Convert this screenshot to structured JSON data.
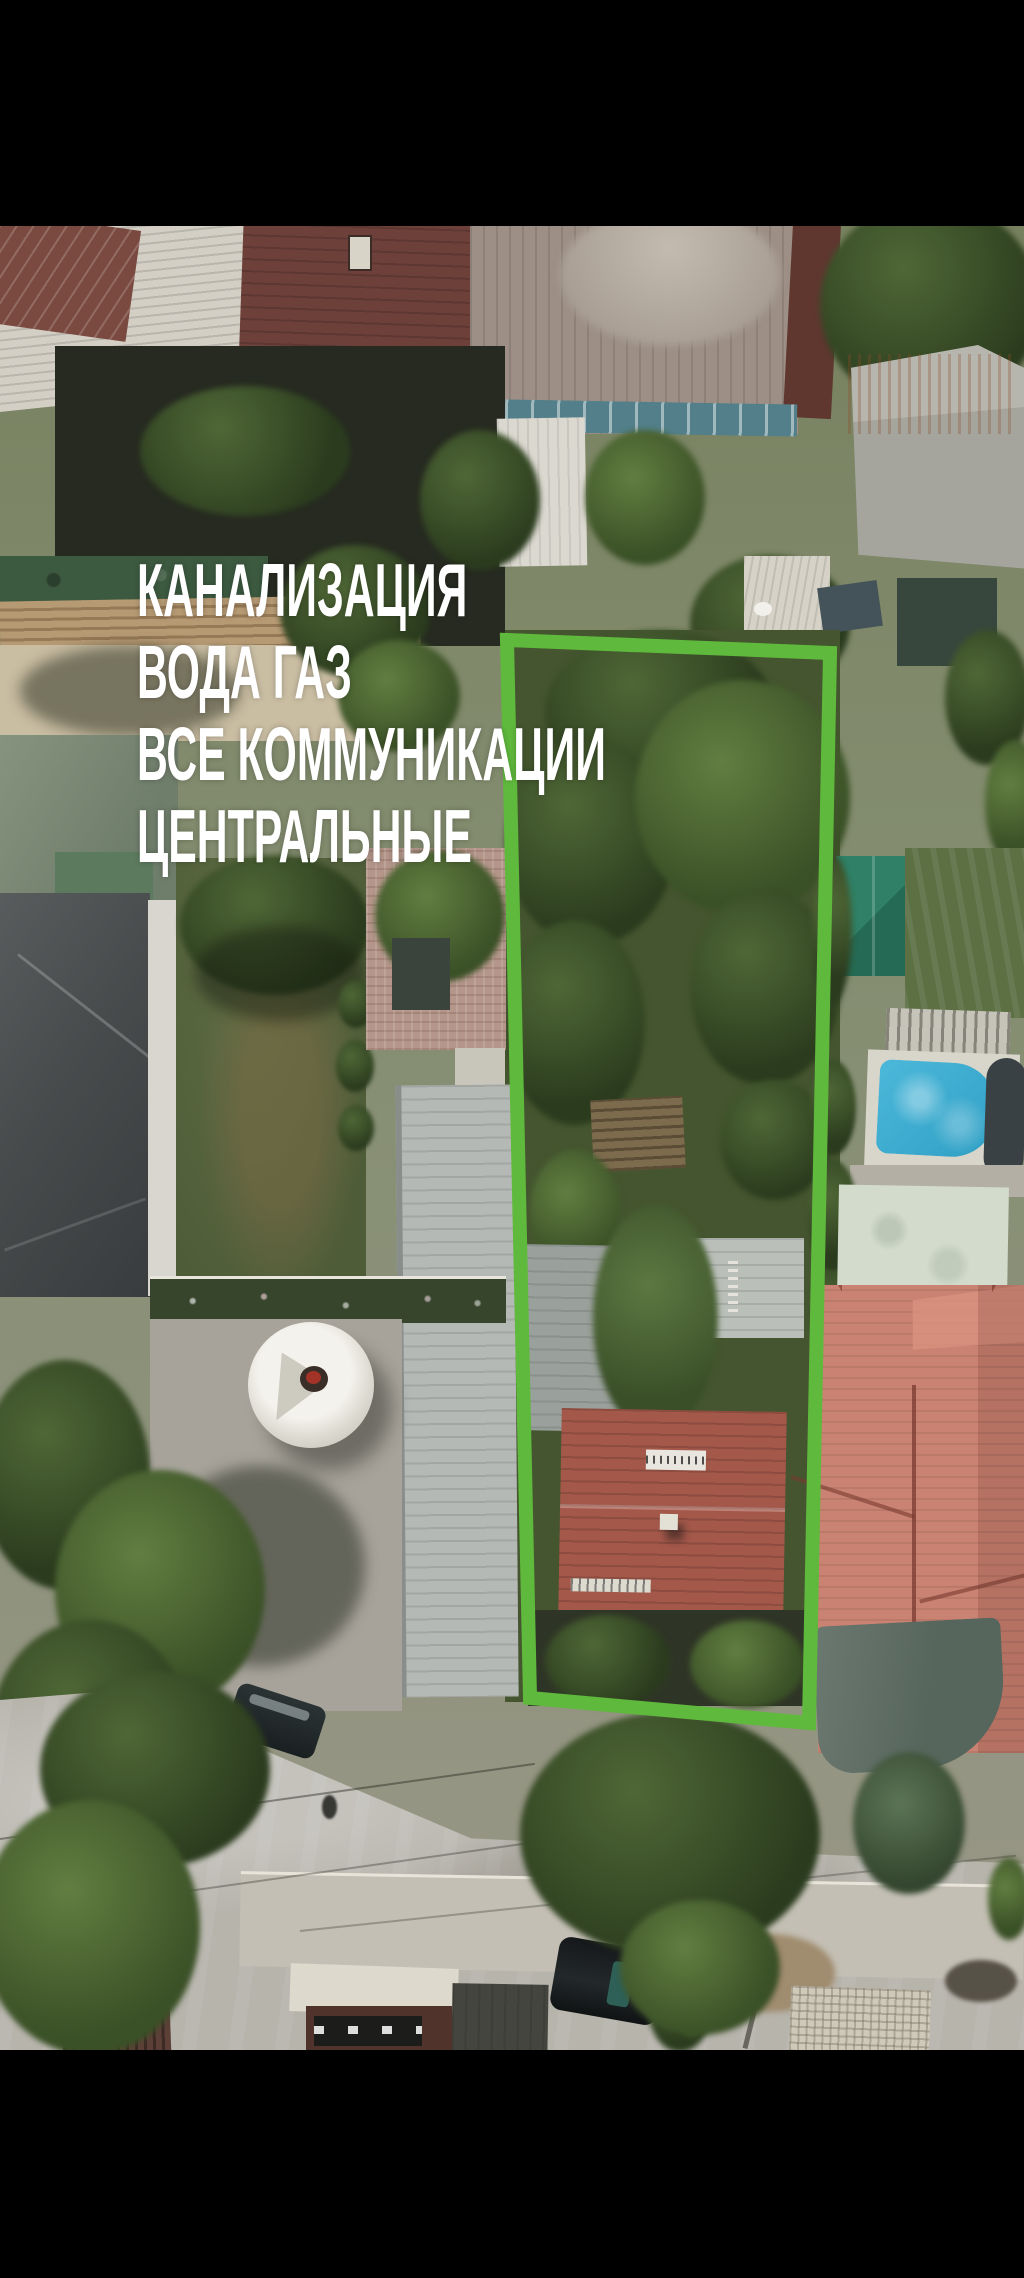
{
  "video_frame": {
    "letterbox_color": "#000000"
  },
  "overlay": {
    "lines": [
      "КАНАЛИЗАЦИЯ",
      "ВОДА ГАЗ",
      "ВСЕ КОММУНИКАЦИИ",
      "ЦЕНТРАЛЬНЫЕ"
    ],
    "text_color": "#ffffff"
  },
  "plot_marker": {
    "shape": "rectangle-outline",
    "color": "#5fb93c"
  }
}
